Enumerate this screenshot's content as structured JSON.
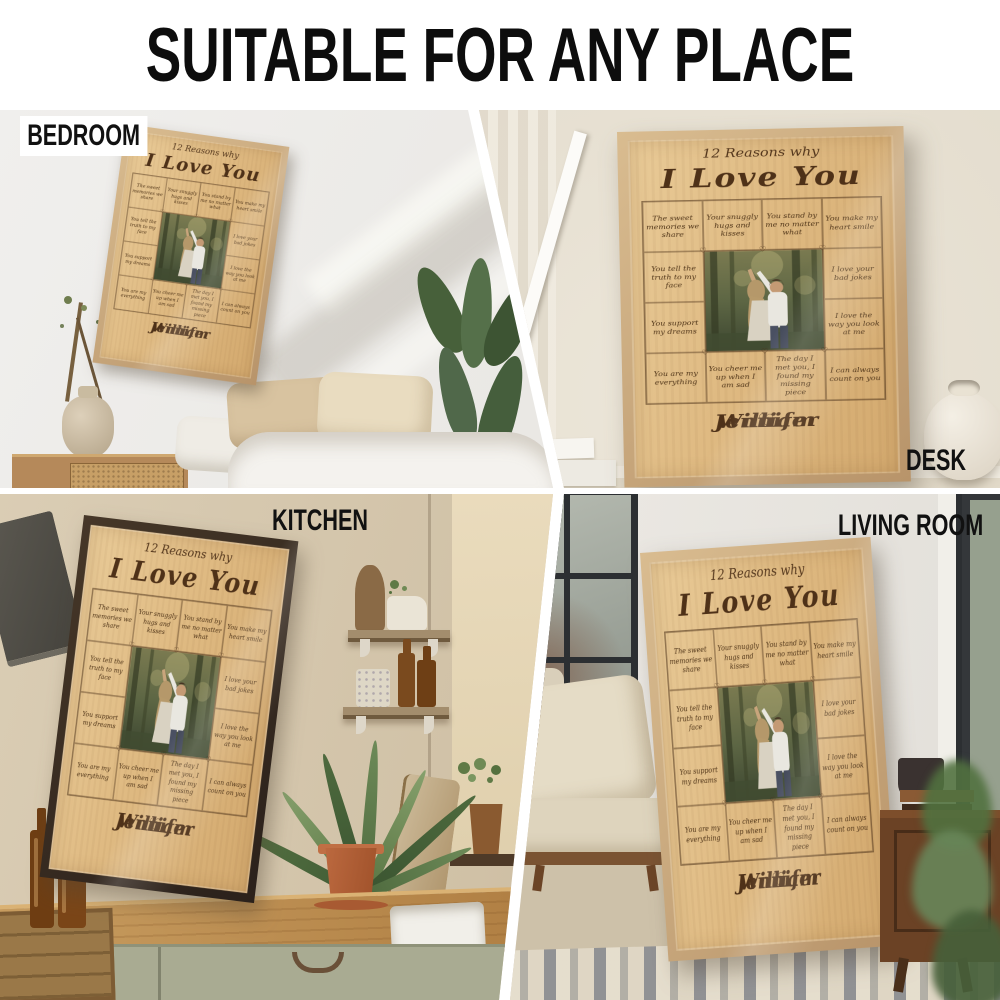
{
  "header": {
    "title": "SUITABLE FOR ANY PLACE"
  },
  "poster": {
    "title_line1": "12 Reasons why",
    "title_line2": "I Love You",
    "reasons": [
      "The sweet memories we share",
      "Your snuggly hugs and kisses",
      "You stand by me no matter what",
      "You make my heart smile",
      "You tell the truth to my face",
      "I love your bad jokes",
      "You support my dreams",
      "I love the way you look at me",
      "You are my everything",
      "You cheer me up when I am sad",
      "The day I met you, I found my missing piece",
      "I can always count on you"
    ],
    "name_left": "William",
    "heart": "♡",
    "name_right": "Jennifer",
    "colors": {
      "wood_paper": "#dfba82",
      "frame_light": "#c9a874",
      "frame_dark": "#362a21",
      "engraving_text": "#4e3118"
    }
  },
  "scenes": [
    {
      "id": "bedroom",
      "label": "BEDROOM"
    },
    {
      "id": "desk",
      "label": "DESK"
    },
    {
      "id": "kitchen",
      "label": "KITCHEN"
    },
    {
      "id": "living-room",
      "label": "LIVING ROOM"
    }
  ]
}
